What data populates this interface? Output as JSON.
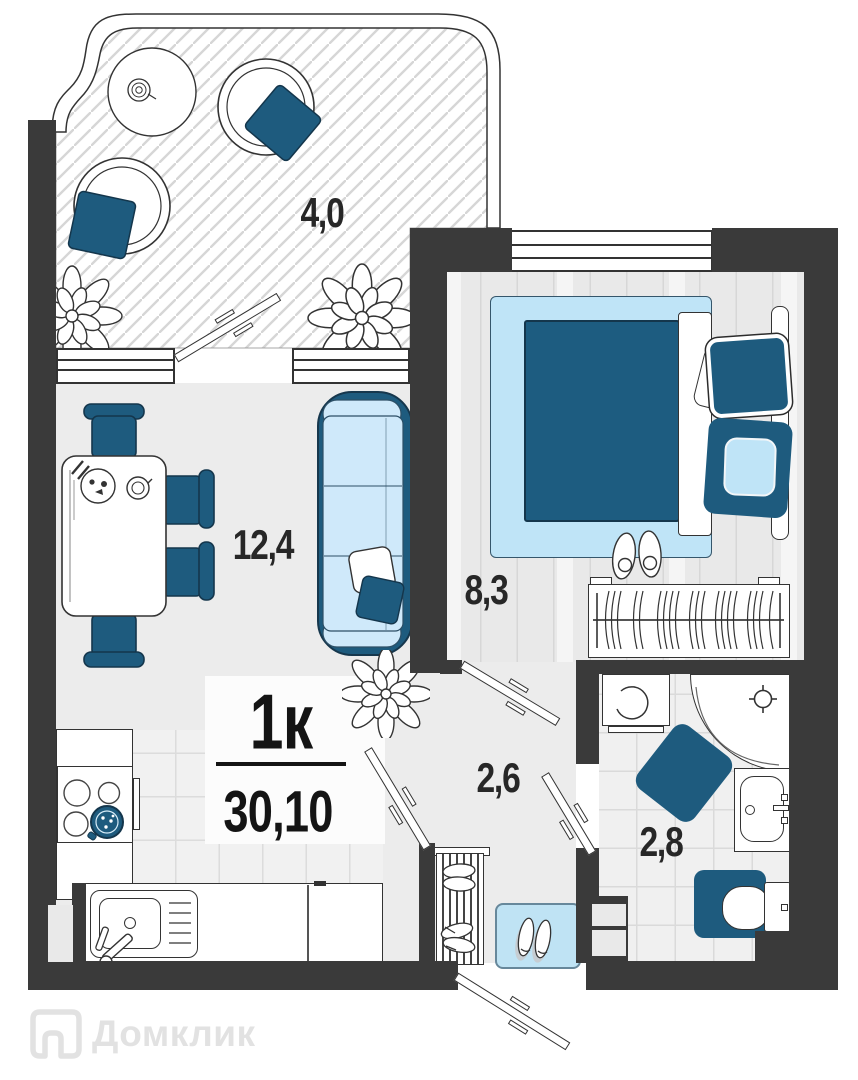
{
  "plan": {
    "type_label": "1к",
    "total_area": "30,10",
    "watermark": "Домклик",
    "rooms": [
      {
        "id": "balcony",
        "area": "4,0"
      },
      {
        "id": "living-kitchen",
        "area": "12,4"
      },
      {
        "id": "bedroom",
        "area": "8,3"
      },
      {
        "id": "hallway",
        "area": "2,6"
      },
      {
        "id": "bathroom",
        "area": "2,8"
      }
    ],
    "colors": {
      "wall": "#3a3a3a",
      "dark_blue": "#1e5b7e",
      "light_blue": "#c9e8f9",
      "floor": "#ececec",
      "tile_line": "#dadada",
      "outline": "#333333",
      "watermark_gray": "#e2e2e2"
    }
  }
}
